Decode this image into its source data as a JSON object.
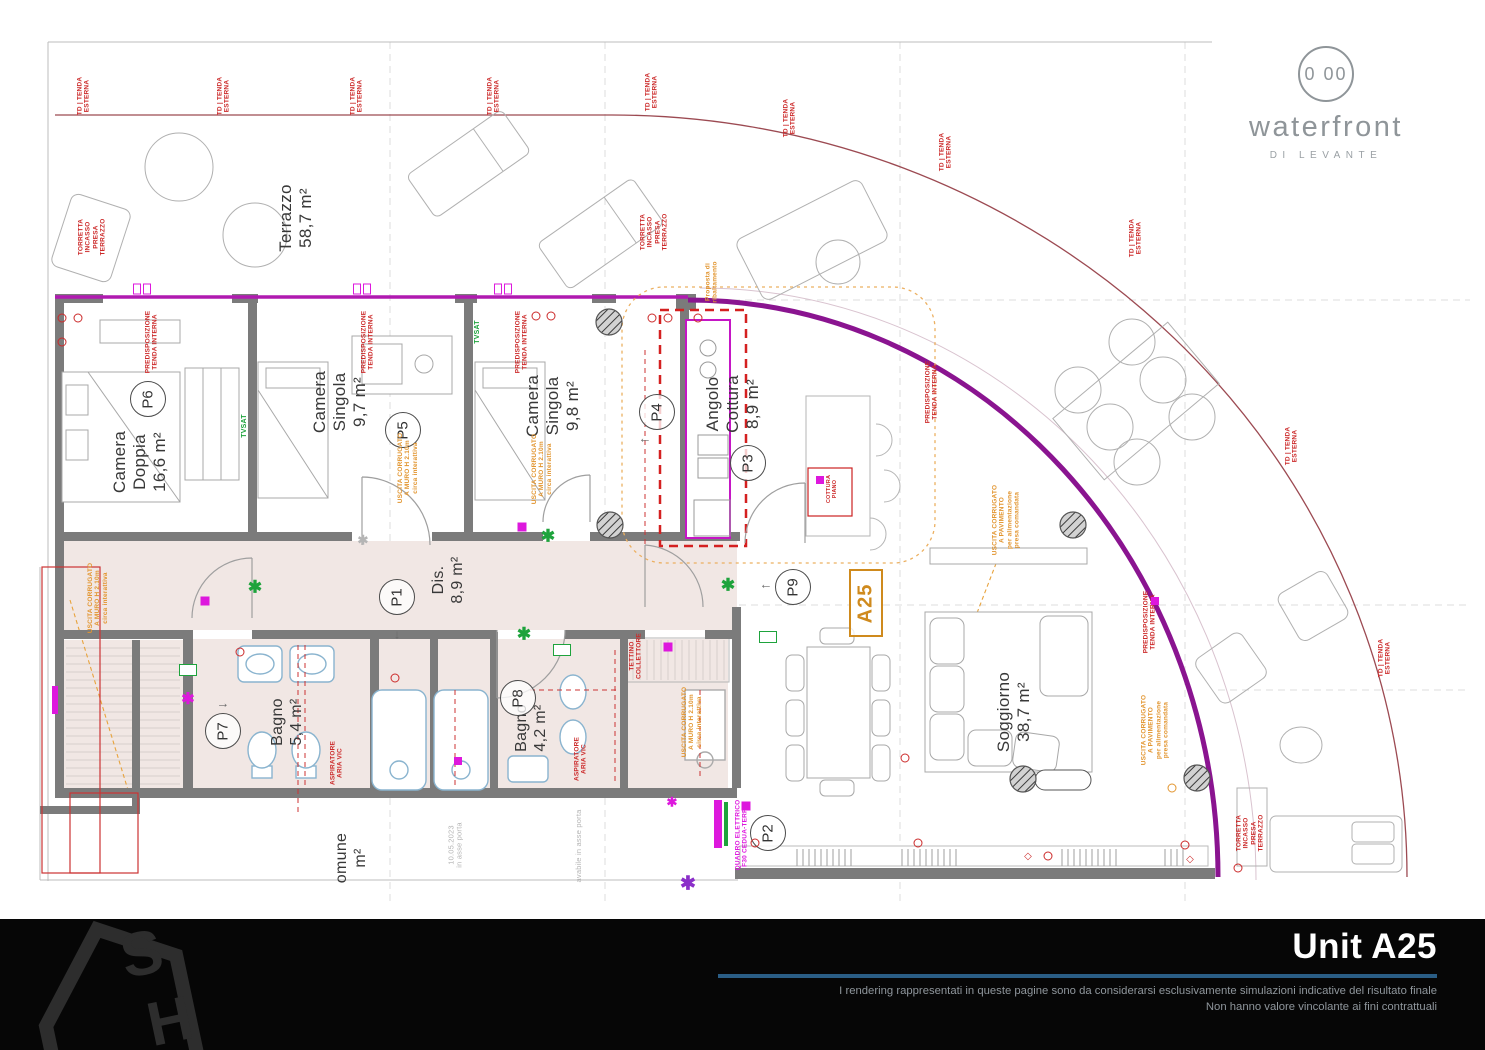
{
  "logo": {
    "circle_text": "0 00",
    "brand": "waterfront",
    "sub": "DI LEVANTE"
  },
  "footer": {
    "title": "Unit A25",
    "line1": "I rendering rappresentati in queste pagine sono da considerarsi esclusivamente simulazioni indicative del risultato finale",
    "line2": "Non hanno valore vincolante ai fini contrattuali",
    "logo_letters": [
      "S",
      "H"
    ]
  },
  "unit_box": {
    "label": "A25",
    "x": 866,
    "y": 603
  },
  "rooms": [
    {
      "label": "Terrazzo\n58,7 m²",
      "x": 296,
      "y": 218,
      "fs": 17
    },
    {
      "label": "Camera\nDoppia\n16,6 m²",
      "x": 140,
      "y": 462,
      "fs": 17
    },
    {
      "label": "Camera\nSingola\n9,7 m²",
      "x": 340,
      "y": 402,
      "fs": 17
    },
    {
      "label": "Camera\nSingola\n9,8 m²",
      "x": 553,
      "y": 406,
      "fs": 17
    },
    {
      "label": "Angolo\nCottura\n8,9 m²",
      "x": 733,
      "y": 404,
      "fs": 17
    },
    {
      "label": "Dis.\n8,9 m²",
      "x": 449,
      "y": 580,
      "fs": 16
    },
    {
      "label": "Bagno\n5,4 m²",
      "x": 288,
      "y": 722,
      "fs": 16
    },
    {
      "label": "Bagno\n4,2 m²",
      "x": 532,
      "y": 728,
      "fs": 16
    },
    {
      "label": "Soggiorno\n38,7 m²",
      "x": 1014,
      "y": 712,
      "fs": 17
    },
    {
      "label": "omune\nm²",
      "x": 352,
      "y": 858,
      "fs": 16
    }
  ],
  "markers": [
    {
      "id": "P1",
      "x": 397,
      "y": 597,
      "arrow": "↓",
      "ax": 397,
      "ay": 634
    },
    {
      "id": "P2",
      "x": 768,
      "y": 833
    },
    {
      "id": "P3",
      "x": 748,
      "y": 463
    },
    {
      "id": "P4",
      "x": 657,
      "y": 412,
      "arrow": "←",
      "ax": 645,
      "ay": 438
    },
    {
      "id": "P5",
      "x": 403,
      "y": 430
    },
    {
      "id": "P6",
      "x": 148,
      "y": 399
    },
    {
      "id": "P7",
      "x": 223,
      "y": 731,
      "arrow": "→",
      "ax": 223,
      "ay": 703
    },
    {
      "id": "P8",
      "x": 518,
      "y": 698
    },
    {
      "id": "P9",
      "x": 793,
      "y": 587,
      "arrow": "←",
      "ax": 766,
      "ay": 584
    }
  ],
  "annotations": [
    {
      "t": "TD |  TENDA\nESTERNA",
      "x": 84,
      "y": 96,
      "c": "red"
    },
    {
      "t": "TD |  TENDA\nESTERNA",
      "x": 224,
      "y": 96,
      "c": "red"
    },
    {
      "t": "TD |  TENDA\nESTERNA",
      "x": 357,
      "y": 96,
      "c": "red"
    },
    {
      "t": "TD |  TENDA\nESTERNA",
      "x": 494,
      "y": 96,
      "c": "red"
    },
    {
      "t": "TD |  TENDA\nESTERNA",
      "x": 652,
      "y": 92,
      "c": "red"
    },
    {
      "t": "TD |  TENDA\nESTERNA",
      "x": 790,
      "y": 118,
      "c": "red"
    },
    {
      "t": "TD |  TENDA\nESTERNA",
      "x": 946,
      "y": 152,
      "c": "red"
    },
    {
      "t": "TD |  TENDA\nESTERNA",
      "x": 1136,
      "y": 238,
      "c": "red"
    },
    {
      "t": "TD |  TENDA\nESTERNA",
      "x": 1292,
      "y": 446,
      "c": "red"
    },
    {
      "t": "TD |  TENDA\nESTERNA",
      "x": 1385,
      "y": 658,
      "c": "red"
    },
    {
      "t": "TORRETTA\nINCASSO\nPRESA\nTERRAZZO",
      "x": 92,
      "y": 237,
      "c": "red"
    },
    {
      "t": "TORRETTA\nINCASSO\nPRESA\nTERRAZZO",
      "x": 654,
      "y": 232,
      "c": "red"
    },
    {
      "t": "TORRETTA\nINCASSO\nPRESA\nTERRAZZO",
      "x": 1250,
      "y": 833,
      "c": "red"
    },
    {
      "t": "PREDISPOSIZIONE\nTENDA INTERNA",
      "x": 152,
      "y": 342,
      "c": "red"
    },
    {
      "t": "PREDISPOSIZIONE\nTENDA INTERNA",
      "x": 368,
      "y": 342,
      "c": "red"
    },
    {
      "t": "PREDISPOSIZIONE\nTENDA INTERNA",
      "x": 522,
      "y": 342,
      "c": "red"
    },
    {
      "t": "PREDISPOSIZIONE\nTENDA INTERNA",
      "x": 932,
      "y": 392,
      "c": "red"
    },
    {
      "t": "PREDISPOSIZIONE\nTENDA INTERNA",
      "x": 1150,
      "y": 622,
      "c": "red"
    },
    {
      "t": "USCITA CORRUGATO\nA MURO H 2.10m\ncirca interattiva",
      "x": 98,
      "y": 598,
      "c": "orange"
    },
    {
      "t": "USCITA CORRUGATO\nA MURO H 2.10m\ncirca interattiva",
      "x": 408,
      "y": 468,
      "c": "orange"
    },
    {
      "t": "USCITA CORRUGATO\nA MURO H 2.10m\ncirca interattiva",
      "x": 542,
      "y": 469,
      "c": "orange"
    },
    {
      "t": "USCITA CORRUGATO\nA MURO H 2.10m\ncirca interattiva",
      "x": 692,
      "y": 722,
      "c": "orange"
    },
    {
      "t": "USCITA CORRUGATO\nA PAVIMENTO\nper alimentazione\npresa comandata",
      "x": 1006,
      "y": 520,
      "c": "orange"
    },
    {
      "t": "USCITA CORRUGATO\nA PAVIMENTO\nper alimentazione\npresa comandata",
      "x": 1155,
      "y": 730,
      "c": "orange"
    },
    {
      "t": "Proposta di\nribaltamento",
      "x": 712,
      "y": 282,
      "c": "orange"
    },
    {
      "t": "COTTURA\nPIANO",
      "x": 832,
      "y": 489,
      "c": "red",
      "fs": 5.5
    },
    {
      "t": "TETTINO\nCOLLETTORE",
      "x": 636,
      "y": 656,
      "c": "red"
    },
    {
      "t": "QUADRO ELETTRICO\nF30 CEDUA-TERRA",
      "x": 742,
      "y": 835,
      "c": "magenta"
    },
    {
      "t": "ASPIRATORE\nARIA VIC",
      "x": 337,
      "y": 763,
      "c": "red"
    },
    {
      "t": "ASPIRATORE\nARIA VIC",
      "x": 581,
      "y": 759,
      "c": "red"
    },
    {
      "t": "TVSAT",
      "x": 245,
      "y": 426,
      "c": "green",
      "fs": 7
    },
    {
      "t": "TVSAT",
      "x": 478,
      "y": 332,
      "c": "green",
      "fs": 7
    },
    {
      "t": "10.05.2023\nin asse porta",
      "x": 456,
      "y": 845,
      "c": "grey",
      "fs": 7.5
    },
    {
      "t": "avabile in asse porta",
      "x": 579,
      "y": 846,
      "c": "grey",
      "fs": 7.5
    }
  ],
  "symbols": [
    {
      "k": "ast",
      "x": 255,
      "y": 587,
      "c": "green",
      "s": 17
    },
    {
      "k": "ast",
      "x": 548,
      "y": 536,
      "c": "green",
      "s": 17
    },
    {
      "k": "ast",
      "x": 524,
      "y": 634,
      "c": "green",
      "s": 17
    },
    {
      "k": "ast",
      "x": 728,
      "y": 585,
      "c": "green",
      "s": 17
    },
    {
      "k": "ast",
      "x": 188,
      "y": 700,
      "c": "magenta",
      "s": 16
    },
    {
      "k": "ast",
      "x": 672,
      "y": 802,
      "c": "magenta",
      "s": 13
    },
    {
      "k": "ast",
      "x": 688,
      "y": 884,
      "c": "violet",
      "s": 19
    },
    {
      "k": "ast",
      "x": 363,
      "y": 540,
      "c": "grey",
      "s": 13
    },
    {
      "k": "sq",
      "x": 205,
      "y": 601,
      "c": "magenta",
      "s": 9
    },
    {
      "k": "sq",
      "x": 522,
      "y": 527,
      "c": "magenta",
      "s": 9
    },
    {
      "k": "sq",
      "x": 668,
      "y": 647,
      "c": "magenta",
      "s": 9
    },
    {
      "k": "sq",
      "x": 746,
      "y": 806,
      "c": "magenta",
      "s": 9
    },
    {
      "k": "sq",
      "x": 458,
      "y": 761,
      "c": "magenta",
      "s": 8
    },
    {
      "k": "sq",
      "x": 1155,
      "y": 601,
      "c": "magenta",
      "s": 8
    },
    {
      "k": "sq",
      "x": 820,
      "y": 480,
      "c": "magenta",
      "s": 8
    },
    {
      "k": "box",
      "x": 188,
      "y": 670,
      "c": "green"
    },
    {
      "k": "box",
      "x": 562,
      "y": 650,
      "c": "green"
    },
    {
      "k": "box",
      "x": 768,
      "y": 637,
      "c": "green"
    },
    {
      "k": "outlet",
      "x": 62,
      "y": 318,
      "c": "red"
    },
    {
      "k": "outlet",
      "x": 78,
      "y": 318,
      "c": "red"
    },
    {
      "k": "outlet",
      "x": 62,
      "y": 342,
      "c": "red"
    },
    {
      "k": "outlet",
      "x": 536,
      "y": 316,
      "c": "red"
    },
    {
      "k": "outlet",
      "x": 551,
      "y": 316,
      "c": "red"
    },
    {
      "k": "outlet",
      "x": 652,
      "y": 318,
      "c": "red"
    },
    {
      "k": "outlet",
      "x": 668,
      "y": 318,
      "c": "red"
    },
    {
      "k": "outlet",
      "x": 698,
      "y": 318,
      "c": "red"
    },
    {
      "k": "outlet",
      "x": 240,
      "y": 652,
      "c": "red"
    },
    {
      "k": "outlet",
      "x": 395,
      "y": 678,
      "c": "red"
    },
    {
      "k": "outlet",
      "x": 905,
      "y": 758,
      "c": "red"
    },
    {
      "k": "outlet",
      "x": 1048,
      "y": 856,
      "c": "red"
    },
    {
      "k": "outlet",
      "x": 755,
      "y": 843,
      "c": "red"
    },
    {
      "k": "outlet",
      "x": 918,
      "y": 843,
      "c": "red"
    },
    {
      "k": "outlet",
      "x": 1185,
      "y": 845,
      "c": "red"
    },
    {
      "k": "outlet",
      "x": 1238,
      "y": 868,
      "c": "red"
    },
    {
      "k": "outlet",
      "x": 1172,
      "y": 788,
      "c": "orange"
    },
    {
      "k": "dia",
      "x": 1028,
      "y": 857,
      "c": "red"
    },
    {
      "k": "dia",
      "x": 1190,
      "y": 860,
      "c": "red"
    },
    {
      "k": "winbrk",
      "x": 142,
      "y": 289,
      "c": "magenta"
    },
    {
      "k": "winbrk",
      "x": 362,
      "y": 289,
      "c": "magenta"
    },
    {
      "k": "winbrk",
      "x": 503,
      "y": 289,
      "c": "magenta"
    }
  ],
  "colors": {
    "red": "#cc2a2a",
    "orange": "#e2952f",
    "green": "#1ea33c",
    "magenta": "#dd18dd",
    "violet": "#8b2fc9",
    "grey": "#b5b5b5",
    "wall": "#7b7b7b",
    "purple_arc": "#8a1490",
    "dark_red_arc": "#9c4a52",
    "pink_floor": "#f1e7e4",
    "accent_blue": "#2a5d85",
    "label": "#383838",
    "logo_grey": "#8f9599",
    "footer_bg": "#060606",
    "footer_text": "#8f969c"
  }
}
